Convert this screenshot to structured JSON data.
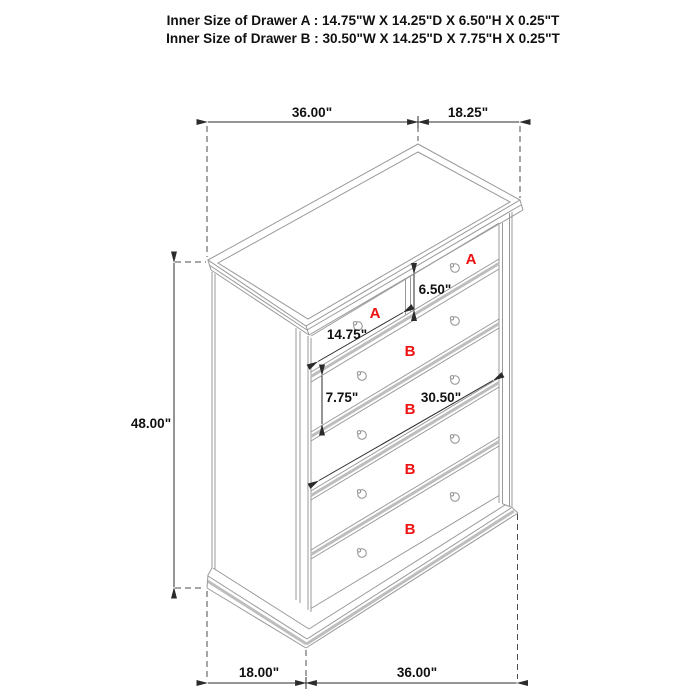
{
  "title_block": {
    "line1": "Inner Size of Drawer A : 14.75\"W X 14.25\"D X 6.50\"H X 0.25\"T",
    "line2": "Inner Size of Drawer B : 30.50\"W X 14.25\"D X 7.75\"H X 0.25\"T"
  },
  "dimensions": {
    "top_width": "36.00\"",
    "top_depth": "18.25\"",
    "overall_height": "48.00\"",
    "drawer_a_height": "6.50\"",
    "drawer_a_width": "14.75\"",
    "drawer_b_height": "7.75\"",
    "drawer_b_width": "30.50\"",
    "base_depth": "18.00\"",
    "base_width": "36.00\""
  },
  "drawer_labels": [
    "A",
    "A",
    "B",
    "B",
    "B",
    "B"
  ],
  "colors": {
    "furniture_line_gray": "#999999",
    "shadow_band_gray": "#bdbdbd",
    "dimension_black": "#2b2b2b",
    "drawer_label_red": "#ee1111"
  }
}
